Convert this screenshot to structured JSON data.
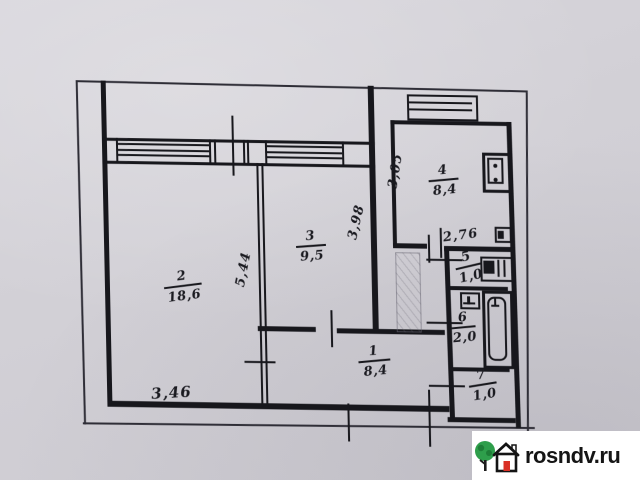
{
  "floor_plan": {
    "rooms": [
      {
        "number": "1",
        "area": "8,4"
      },
      {
        "number": "2",
        "area": "18,6"
      },
      {
        "number": "3",
        "area": "9,5"
      },
      {
        "number": "4",
        "area": "8,4"
      },
      {
        "number": "5",
        "area": "1,0"
      },
      {
        "number": "6",
        "area": "2,0"
      },
      {
        "number": "7",
        "area": "1,0"
      }
    ],
    "dimensions": [
      {
        "value": "3,46"
      },
      {
        "value": "5,44"
      },
      {
        "value": "3,98"
      },
      {
        "value": "3,05"
      },
      {
        "value": "2,76"
      }
    ],
    "icons": [
      "window-icon",
      "kitchen-stove-icon",
      "vent-box-icon",
      "sink-icon",
      "toilet-icon",
      "bathtub-icon",
      "built-in-closet-icon"
    ],
    "colors": {
      "paper": "#d2d0d6",
      "ink": "#17171c",
      "pencil": "#2e2d36"
    }
  },
  "watermark": {
    "site": "rosndv.ru",
    "colors": {
      "background": "#ffffff",
      "text": "#151515",
      "tree": "#2e9e4b",
      "door": "#d93025"
    }
  }
}
